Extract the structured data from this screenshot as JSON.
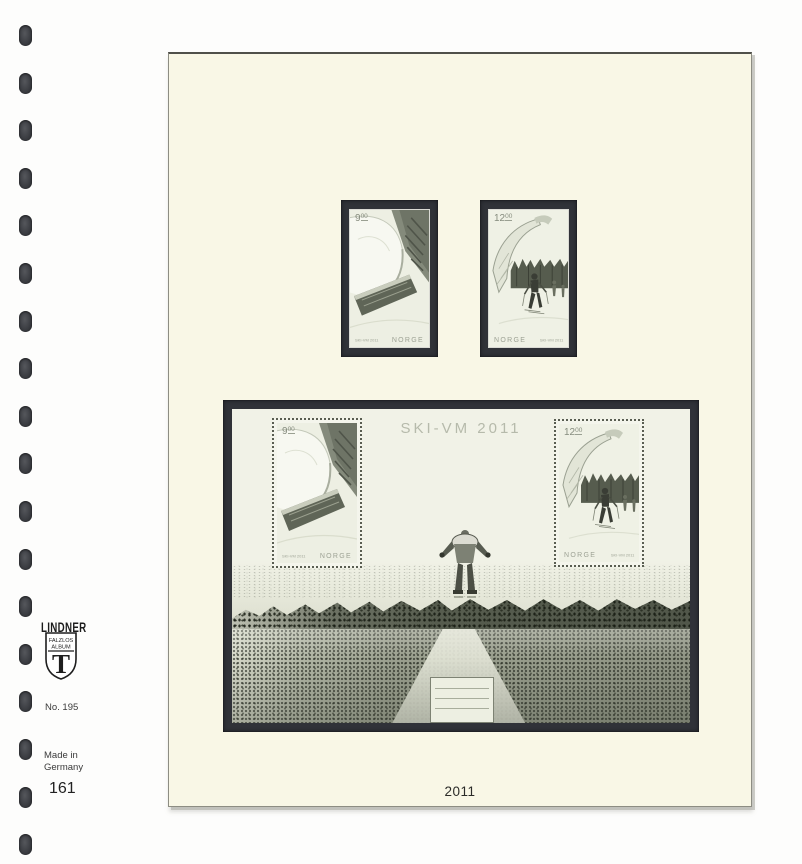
{
  "album_page": {
    "year_label": "2011"
  },
  "binder": {
    "hole_count": 18
  },
  "sidebar": {
    "brand": "LINDNER",
    "shield": {
      "line1": "FALZLOS",
      "line2": "ALBUM",
      "letter": "T"
    },
    "ref_no": "No. 195",
    "origin_line1": "Made in",
    "origin_line2": "Germany",
    "page_number": "161"
  },
  "sheet": {
    "title": "SKI-VM 2011"
  },
  "stamps": {
    "kr9": {
      "value": "9",
      "cents": "00",
      "country": "NORGE",
      "inscription": "SKI-VM 2011"
    },
    "kr12": {
      "value": "12",
      "cents": "00",
      "country": "NORGE",
      "inscription": "SKI-VM 2011"
    }
  },
  "colors": {
    "page_bg": "#f9f7e6",
    "mount_frame": "#303238",
    "stamp_bg": "#edefe3",
    "sheet_bg": "#f1f2e7",
    "title_gray": "#b6baab",
    "tree_dark": "#565c4e"
  }
}
